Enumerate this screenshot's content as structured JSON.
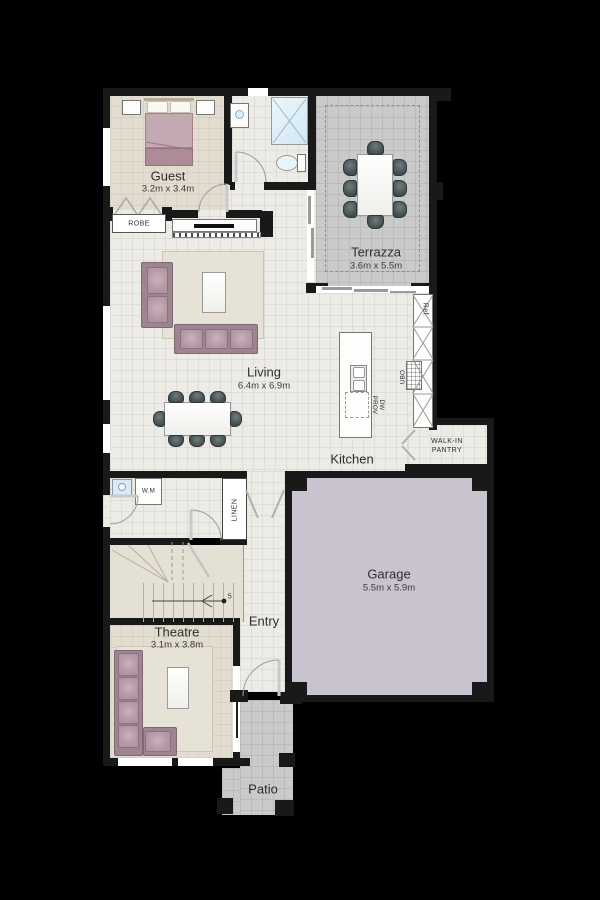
{
  "rooms": {
    "guest": {
      "label": "Guest",
      "dims": "3.2m x 3.4m"
    },
    "terrazza": {
      "label": "Terrazza",
      "dims": "3.6m  x 5.5m"
    },
    "living": {
      "label": "Living",
      "dims": "6.4m x 6.9m"
    },
    "kitchen": {
      "label": "Kitchen"
    },
    "garage": {
      "label": "Garage",
      "dims": "5.5m x 5.9m"
    },
    "theatre": {
      "label": "Theatre",
      "dims": "3.1m x 3.8m"
    },
    "entry": {
      "label": "Entry"
    },
    "patio": {
      "label": "Patio"
    },
    "robe": {
      "label": "ROBE"
    },
    "linen": {
      "label": "LINEN"
    },
    "pantry": {
      "line1": "WALK-IN",
      "line2": "PANTRY"
    }
  },
  "fixtures": {
    "washing_machine": "W.M",
    "fridge": "Ref.",
    "oven": "UBO",
    "dw_line1": "DW",
    "dw_line2": "PROV",
    "stair_marker": "5"
  },
  "colors": {
    "background": "#000000",
    "wall": "#191919",
    "floor_light": "#edebe5",
    "floor_beige": "#e3ddd0",
    "outdoor_gray": "#cacaca",
    "garage_fill": "#c8c3ce",
    "sofa_mauve": "#b094a0",
    "bed_mauve": "#c3a9b2",
    "water_blue": "#d8eaf6",
    "chair_dark": "#4a5456"
  }
}
